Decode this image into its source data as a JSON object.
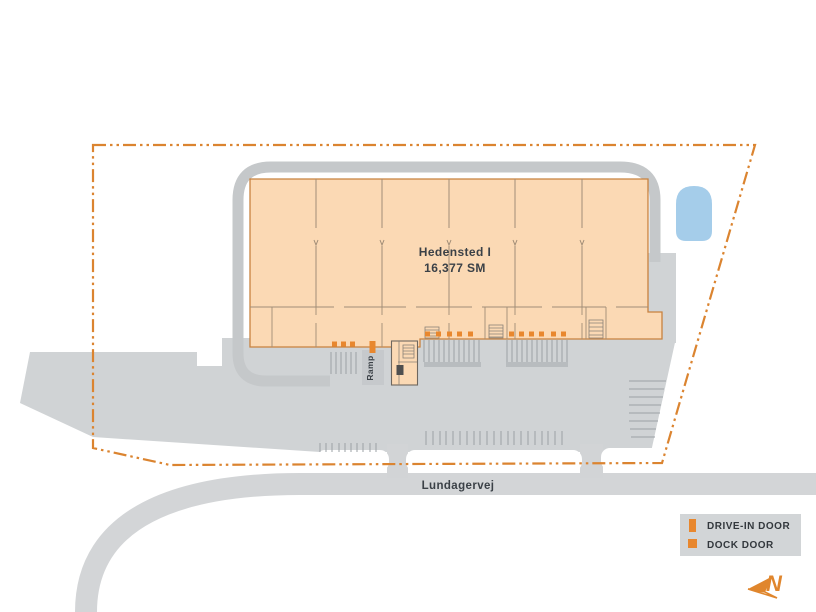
{
  "plan": {
    "building": {
      "name": "Hedensted I",
      "area": "16,377 SM"
    },
    "ramp": {
      "label": "Ramp"
    },
    "road": {
      "label": "Lundagervej"
    },
    "legend": {
      "items": [
        {
          "icon": "drive-in-door-swatch",
          "label": "DRIVE-IN DOOR"
        },
        {
          "icon": "dock-door-swatch",
          "label": "DOCK DOOR"
        }
      ]
    },
    "compass": {
      "label": "N"
    },
    "colors": {
      "building_fill": "#FBD9B4",
      "building_outline": "#C8823F",
      "interior_wall": "#A08D77",
      "door_orange": "#E8872E",
      "boundary_orange": "#DB8430",
      "pond_blue": "#A5CDEA",
      "paving_gray": "#D2D4D6",
      "road_loop_gray": "#C5C8CA",
      "hatch_gray": "#9BA0A5",
      "text_dark": "#3B4147"
    }
  }
}
